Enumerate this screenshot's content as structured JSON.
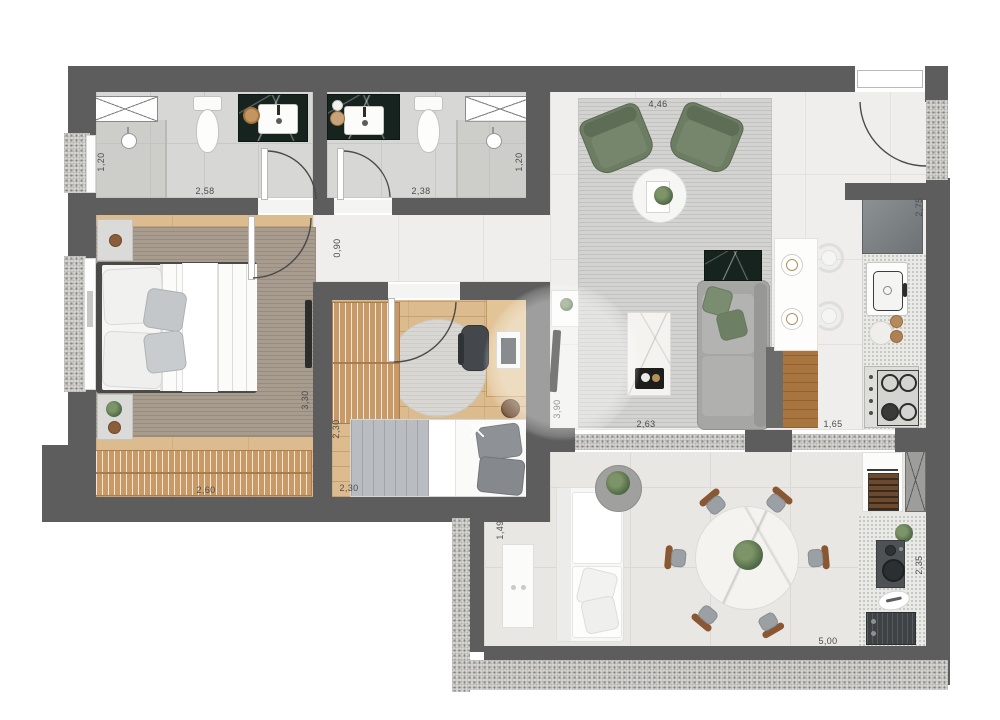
{
  "document": {
    "type": "apartment-floor-plan",
    "units": "meters"
  },
  "dimensions": {
    "bath1_shower_depth": "1,20",
    "bath1_width": "2,58",
    "bath2_width": "2,38",
    "bath2_shower_depth": "1,20",
    "hallway_width": "0,90",
    "living_width": "4,46",
    "kitchen_depth": "2,75",
    "bedroom1_depth": "3,30",
    "living_depth": "3,90",
    "bedroom1_width": "2,60",
    "bedroom2_depth": "2,30",
    "bedroom2_width": "2,30",
    "living_opening_width": "2,63",
    "kitchen_opening_width": "1,65",
    "balcony_left_depth": "1,49",
    "balcony_width": "5,00",
    "barbecue_area_depth": "2,35"
  },
  "colors": {
    "wall": "#5d5d5d",
    "wood_floor": "#dcbb8e",
    "accent_green": "#6d7d64",
    "black_marble": "#16231e",
    "white_marble": "#f4f3f0"
  }
}
